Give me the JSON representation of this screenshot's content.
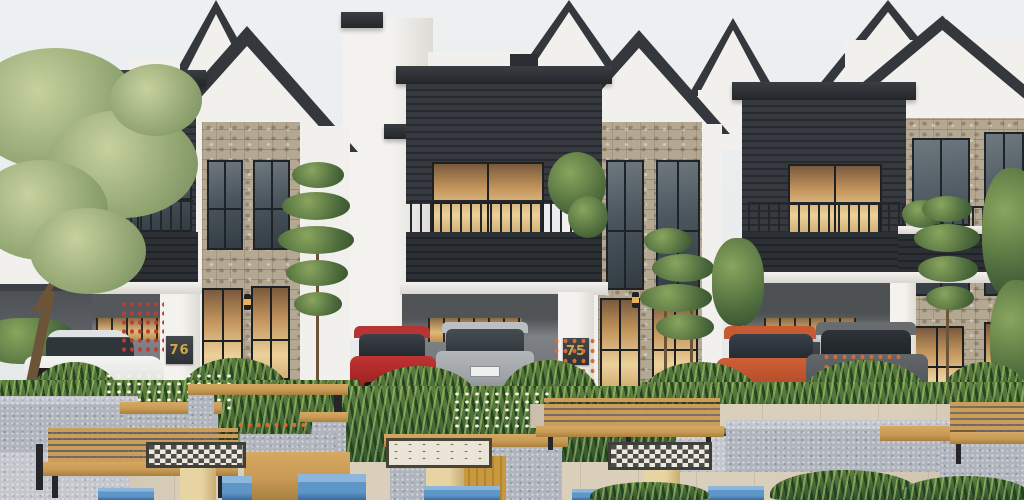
{
  "scene": {
    "kind": "exterior-architectural-render",
    "setting": "Row of modern villas with dark gabled roofs, stone accents, carports and a landscaped community plaza with benches, chess tables and stools"
  },
  "houses": [
    {
      "number": "76"
    },
    {
      "number": "75"
    },
    {
      "number": "74"
    }
  ],
  "cars": [
    {
      "name": "white-sedan",
      "parked_at": "76",
      "color": "#ebebe9"
    },
    {
      "name": "red-hatchback",
      "parked_at": "75",
      "color": "#a32323"
    },
    {
      "name": "silver-wagon",
      "parked_at": "75",
      "color": "#a7aaad"
    },
    {
      "name": "orange-hatchback",
      "parked_at": "74",
      "color": "#b44a28"
    },
    {
      "name": "grey-wagon",
      "parked_at": "74",
      "color": "#56595c"
    }
  ],
  "plaza": {
    "furniture": [
      "wooden-bench",
      "chess-table",
      "info-lectern",
      "blue-stool",
      "planter",
      "pergola-counter",
      "concrete-wall"
    ]
  },
  "palette": {
    "sky": "#e9eced",
    "dark_siding": "#2c2f34",
    "white_wall": "#f1f0ec",
    "stone": "#b5a893",
    "warm_light": "#e0b075",
    "concrete": "#b0b5bd",
    "wood": "#c89a55",
    "stool_blue": "#5e96c8",
    "pavement": "#dacfba",
    "foliage_dark": "#2e5230",
    "foliage_light": "#9cb35a",
    "gold": "#cfa946"
  }
}
